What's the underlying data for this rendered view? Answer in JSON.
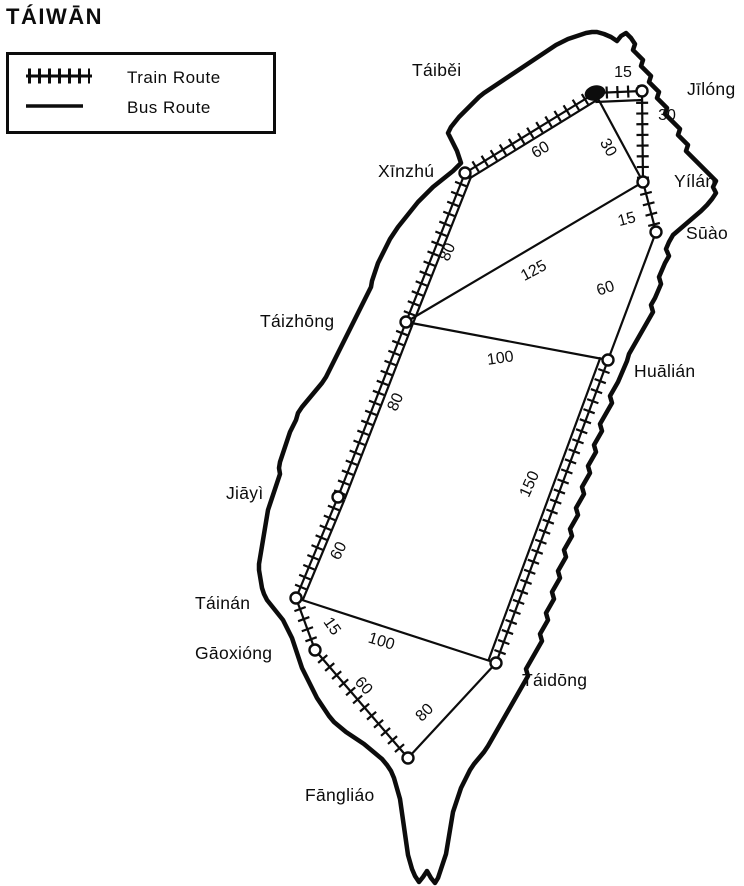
{
  "title": "TÁIWĀN",
  "legend": {
    "train_label": "Train Route",
    "bus_label": "Bus Route"
  },
  "map": {
    "ink_color": "#0c0c0c",
    "cities": [
      {
        "id": "taibei",
        "name": "Táiběi",
        "x": 595,
        "y": 93,
        "filled": true,
        "label_x": 412,
        "label_y": 76
      },
      {
        "id": "jilong",
        "name": "Jīlóng",
        "x": 642,
        "y": 91,
        "filled": false,
        "label_x": 687,
        "label_y": 95
      },
      {
        "id": "yilan",
        "name": "Yílán",
        "x": 643,
        "y": 182,
        "filled": false,
        "label_x": 674,
        "label_y": 187
      },
      {
        "id": "suao",
        "name": "Sūào",
        "x": 656,
        "y": 232,
        "filled": false,
        "label_x": 686,
        "label_y": 239
      },
      {
        "id": "xinzhu",
        "name": "Xīnzhú",
        "x": 465,
        "y": 173,
        "filled": false,
        "label_x": 378,
        "label_y": 177
      },
      {
        "id": "taizhong",
        "name": "Táizhōng",
        "x": 406,
        "y": 322,
        "filled": false,
        "label_x": 260,
        "label_y": 327
      },
      {
        "id": "hualian",
        "name": "Huālián",
        "x": 608,
        "y": 360,
        "filled": false,
        "label_x": 634,
        "label_y": 377
      },
      {
        "id": "jiayi",
        "name": "Jiāyì",
        "x": 338,
        "y": 497,
        "filled": false,
        "label_x": 226,
        "label_y": 499
      },
      {
        "id": "tainan",
        "name": "Táinán",
        "x": 296,
        "y": 598,
        "filled": false,
        "label_x": 195,
        "label_y": 609
      },
      {
        "id": "gaoxiong",
        "name": "Gāoxióng",
        "x": 315,
        "y": 650,
        "filled": false,
        "label_x": 195,
        "label_y": 659
      },
      {
        "id": "fangliao",
        "name": "Fāngliáo",
        "x": 408,
        "y": 758,
        "filled": false,
        "label_x": 305,
        "label_y": 801
      },
      {
        "id": "taidong",
        "name": "Táidōng",
        "x": 496,
        "y": 663,
        "filled": false,
        "label_x": 522,
        "label_y": 686
      }
    ],
    "routes": [
      {
        "from": "taibei",
        "to": "jilong",
        "type": "train+bus",
        "distance": "15",
        "lx": 623,
        "ly": 77,
        "rot": 0,
        "bus_offset": 9
      },
      {
        "from": "jilong",
        "to": "yilan",
        "type": "train",
        "distance": "30",
        "lx": 667,
        "ly": 120,
        "rot": 0
      },
      {
        "from": "taibei",
        "to": "yilan",
        "type": "bus",
        "distance": "30",
        "lx": 604,
        "ly": 150,
        "rot": 60
      },
      {
        "from": "taibei",
        "to": "xinzhu",
        "type": "train+bus",
        "distance": "60",
        "lx": 543,
        "ly": 154,
        "rot": -31,
        "bus_offset": -7
      },
      {
        "from": "yilan",
        "to": "suao",
        "type": "train",
        "distance": "15",
        "lx": 628,
        "ly": 224,
        "rot": -15
      },
      {
        "from": "xinzhu",
        "to": "taizhong",
        "type": "train+bus",
        "distance": "80",
        "lx": 452,
        "ly": 254,
        "rot": -66,
        "bus_offset": -7
      },
      {
        "from": "taizhong",
        "to": "yilan",
        "type": "bus",
        "distance": "125",
        "lx": 536,
        "ly": 275,
        "rot": -28
      },
      {
        "from": "suao",
        "to": "hualian",
        "type": "bus",
        "distance": "60",
        "lx": 607,
        "ly": 293,
        "rot": -18
      },
      {
        "from": "taizhong",
        "to": "hualian",
        "type": "bus",
        "distance": "100",
        "lx": 501,
        "ly": 363,
        "rot": -8
      },
      {
        "from": "taizhong",
        "to": "jiayi",
        "type": "train+bus",
        "distance": "80",
        "lx": 400,
        "ly": 404,
        "rot": -66,
        "bus_offset": -7
      },
      {
        "from": "hualian",
        "to": "taidong",
        "type": "train+bus",
        "distance": "150",
        "lx": 534,
        "ly": 486,
        "rot": -66,
        "bus_offset": 8
      },
      {
        "from": "jiayi",
        "to": "tainan",
        "type": "train+bus",
        "distance": "60",
        "lx": 343,
        "ly": 553,
        "rot": -64,
        "bus_offset": -7
      },
      {
        "from": "tainan",
        "to": "gaoxiong",
        "type": "train",
        "distance": "15",
        "lx": 328,
        "ly": 629,
        "rot": 55
      },
      {
        "from": "tainan",
        "to": "taidong",
        "type": "bus",
        "distance": "100",
        "lx": 380,
        "ly": 646,
        "rot": 17
      },
      {
        "from": "gaoxiong",
        "to": "fangliao",
        "type": "train",
        "distance": "60",
        "lx": 360,
        "ly": 689,
        "rot": 48
      },
      {
        "from": "fangliao",
        "to": "taidong",
        "type": "bus",
        "distance": "80",
        "lx": 428,
        "ly": 716,
        "rot": -45
      }
    ]
  }
}
